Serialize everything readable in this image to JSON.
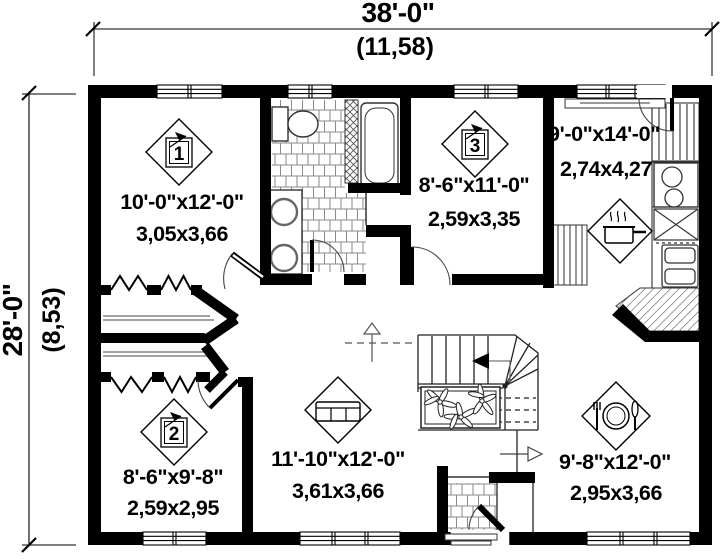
{
  "plan": {
    "dims": {
      "width_ft": "38'-0\"",
      "width_m": "(11,58)",
      "depth_ft": "28'-0\"",
      "depth_m": "(8,53)"
    },
    "rooms": {
      "bedroom1": {
        "number": "1",
        "dim_ft": "10'-0\"x12'-0\"",
        "dim_m": "3,05x3,66"
      },
      "bedroom2": {
        "number": "2",
        "dim_ft": "8'-6\"x9'-8\"",
        "dim_m": "2,59x2,95"
      },
      "bedroom3": {
        "number": "3",
        "dim_ft": "8'-6\"x11'-0\"",
        "dim_m": "2,59x3,35"
      },
      "kitchen": {
        "dim_ft": "9'-0\"x14'-0\"",
        "dim_m": "2,74x4,27"
      },
      "living": {
        "dim_ft": "11'-10\"x12'-0\"",
        "dim_m": "3,61x3,66"
      },
      "dining": {
        "dim_ft": "9'-8\"x12'-0\"",
        "dim_m": "2,95x3,66"
      }
    },
    "colors": {
      "ink": "#000000",
      "paper": "#ffffff",
      "tile_line": "#8a8a8a"
    }
  }
}
